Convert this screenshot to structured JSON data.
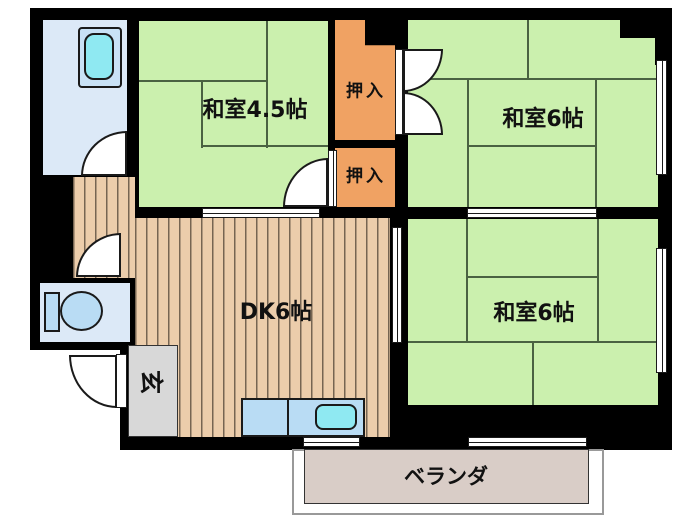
{
  "rooms": {
    "washitsu45": {
      "label": "和室4.5帖"
    },
    "washitsu6_top": {
      "label": "和室6帖"
    },
    "washitsu6_right": {
      "label": "和室6帖"
    },
    "dk": {
      "label": "DK6帖"
    },
    "oshiire_top": {
      "label": "押入"
    },
    "oshiire_bottom": {
      "label": "押入"
    },
    "genkan": {
      "label": "玄"
    },
    "veranda": {
      "label": "ベランダ"
    }
  },
  "fixtures": {
    "bathtub": "bathtub-icon",
    "toilet": "toilet-icon",
    "kitchen_sink": "kitchen-sink-icon"
  },
  "colors": {
    "tatami_green": "#cbf0ae",
    "closet_orange": "#f0a263",
    "wood_floor": "#eccdab",
    "water_room_blue": "#dce9f7",
    "fixture_blue": "#b9dcf4",
    "sink_cyan": "#8fe9f2",
    "genkan_gray": "#d8d8d8",
    "veranda_beige": "#d9cdc7",
    "wall_black": "#000000"
  }
}
